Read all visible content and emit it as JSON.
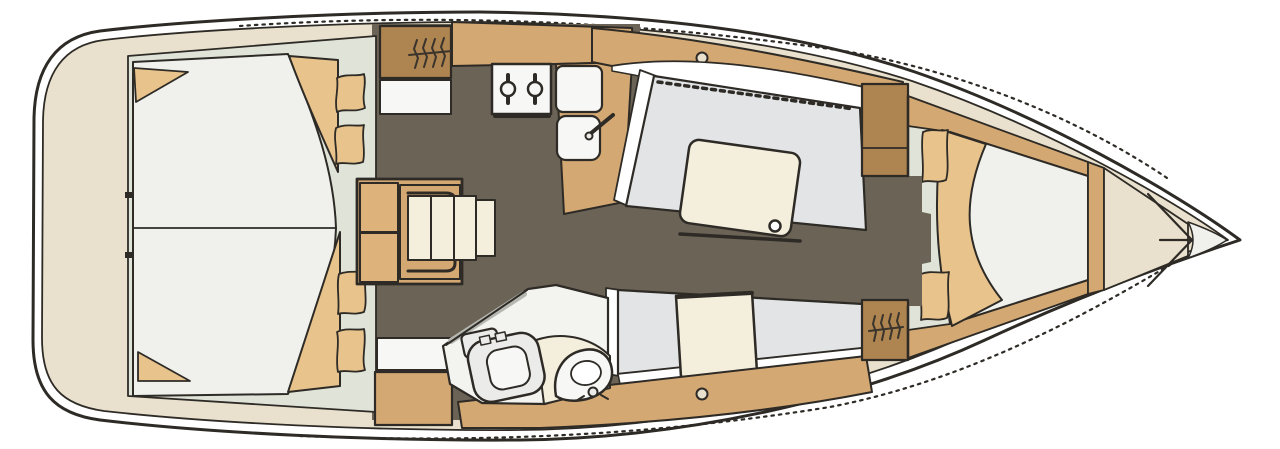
{
  "meta": {
    "type": "floor-plan",
    "subject": "sailing yacht interior layout, top-down plan view, bow pointing right"
  },
  "colors": {
    "stroke": "#2e2b26",
    "ink2": "#3a342c",
    "hull": "#ffffff",
    "deck": "#e9e1cd",
    "cabin": "#e0e4d8",
    "berth": "#f0f1ed",
    "settee": "#e2e4e6",
    "floor": "#6b6356",
    "wood": "#d4a873",
    "woodLight": "#ddb27b",
    "woodDark": "#ae8450",
    "soft": "#e9c38c",
    "cream": "#f4eedd",
    "fixture": "#f7f8f6",
    "fixtureShade": "#ebecea",
    "headFloor": "#f3f3f0",
    "shade": "#b6b7b0"
  },
  "regions": {
    "aft_cabin": "aft double-berth cabin with pillows and folded blanket",
    "companionway": "companionway steps flanked by lockers",
    "galley": "galley with two-burner stove, fridge and sink",
    "salon": "salon with port settee, folding table and starboard seat",
    "head": "head compartment with marine toilet and washbasin",
    "forward_cabin": "forward V-berth cabin with pillows and blanket",
    "anchor_locker": "bow anchor locker",
    "side_decks": "side decks with deck hatches"
  },
  "icons": {
    "stove_burner": "circle with pot-holder bar",
    "deck_hatch": "small circle on side deck",
    "hanging_locker": "zigzag hatch symbol",
    "toilet": "rounded bowl with tank",
    "washbasin": "rounded basin with tap knob",
    "anchor_locker_divider": "V lines converging at bow"
  }
}
